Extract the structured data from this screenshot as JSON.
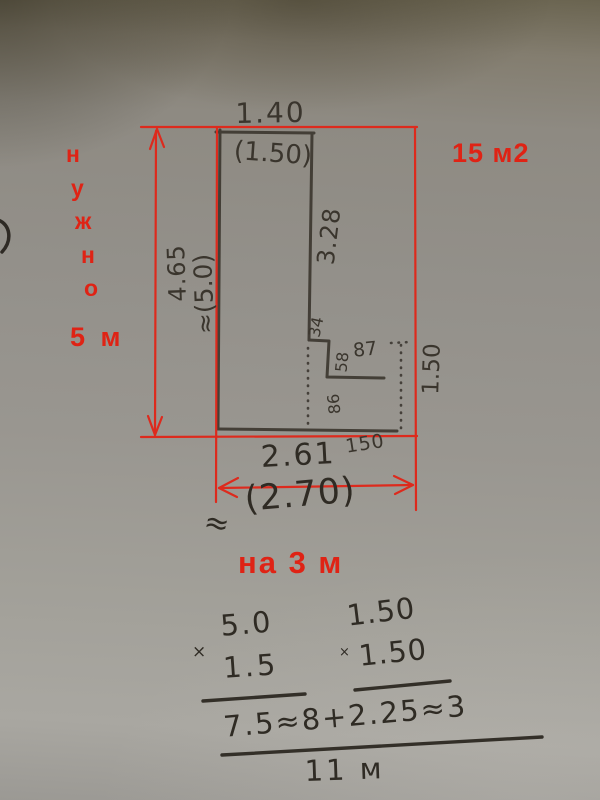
{
  "photo": {
    "red_annotations": {
      "need_letters": [
        "н",
        "у",
        "ж",
        "н",
        "о"
      ],
      "need_value": "5 м",
      "area_label": "15 м2",
      "width_target": "на 3 м",
      "accent_color": "#df2315"
    },
    "pencil_dimensions": {
      "top_width": "1.40",
      "top_width_paren": "(1.50)",
      "left_height": "4.65",
      "left_height_approx": "≈(5.0)",
      "right_upper": "3.28",
      "notch_top": "34",
      "notch_side": "58",
      "notch_width": "87",
      "notch_inner": "86",
      "right_lower": "1.50",
      "bottom_small": "150",
      "bottom_width": "2.61",
      "approx_sign": "≈",
      "bottom_width_paren": "(2.70)"
    },
    "calculations": {
      "mult1_top": "5.0",
      "mult1_sign": "×",
      "mult1_bottom": "1.5",
      "mult2_top": "1.50",
      "mult2_sign": "×",
      "mult2_bottom": "1.50",
      "sum_line": "7.5≈8+2.25≈3",
      "total": "11 м"
    }
  }
}
